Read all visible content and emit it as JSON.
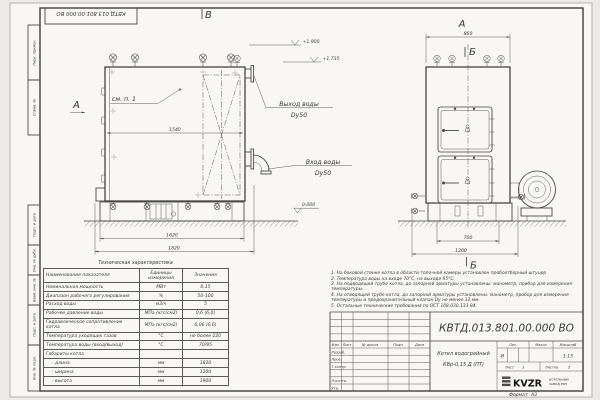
{
  "doc_number": "КВТД.013.801.00.000 ВО",
  "sheet": {
    "format_label": "Формат",
    "format_value": "А3"
  },
  "sidebar": {
    "labels": [
      "Перв. примен.",
      "Справ. №",
      "Подп. и дата",
      "Инв. № дубл.",
      "Взам. инв. №",
      "Подп. и дата",
      "Инв. № подл."
    ]
  },
  "views": {
    "marker_v": "В",
    "marker_a": "А",
    "marker_b": "Б",
    "see_item": "см. п. 1",
    "water_out": {
      "line1": "Выход воды",
      "line2": "Dy50"
    },
    "water_in": {
      "line1": "Вход воды",
      "line2": "Dy50"
    },
    "levels": {
      "top": "+1.900",
      "mid": "+1.735",
      "zero": "0.000"
    },
    "dims": {
      "front_width": "1540",
      "base": "1620",
      "overall": "1820",
      "side_top": "860",
      "side_base": "700",
      "side_overall": "1200"
    }
  },
  "table": {
    "title": "Техническая характеристика",
    "headers": [
      "Наименование показателя",
      "Единицы измерения",
      "Значения"
    ],
    "rows": [
      {
        "name": "Номинальная мощность",
        "unit": "МВт",
        "value": "0,15"
      },
      {
        "name": "Диапазон рабочего регулирования",
        "unit": "%",
        "value": "50-100"
      },
      {
        "name": "Расход воды",
        "unit": "м3/ч",
        "value": "5"
      },
      {
        "name": "Рабочее давление воды",
        "unit": "МПа (кгс/см2)",
        "value": "0,6 (6,0)"
      },
      {
        "name": "Гидравлическое сопротивление котла",
        "unit": "МПа (кгс/см2)",
        "value": "0,06 (0,6)"
      },
      {
        "name": "Температура уходящих газов",
        "unit": "°С",
        "value": "не более 220"
      },
      {
        "name": "Температура воды (вход/выход)",
        "unit": "°С",
        "value": "70/95"
      },
      {
        "name": "Габариты котла",
        "unit": "",
        "value": ""
      },
      {
        "name": "- длина",
        "unit": "мм",
        "value": "1820"
      },
      {
        "name": "- ширина",
        "unit": "мм",
        "value": "1200"
      },
      {
        "name": "- высота",
        "unit": "мм",
        "value": "1900"
      }
    ]
  },
  "notes": [
    "1. На боковой стенке котла в области топочной камеры установлен пробоотборный штуцер",
    "2. Температура воды на входе 70°С, на выходе 95°С.",
    "3. На подводящей трубе котла, до запорной арматуры установлены: манометр, прибор для измерения температуры.",
    "4. На отводящей трубе котла, до запорной арматуры установлены: манометр, прибор для измерения температуры и предохранительный клапан Dу не менее 32 мм.",
    "5. Остальные технические требования по ОСТ 108.030.133-84."
  ],
  "title_block": {
    "doc_number": "КВТД.013.801.00.000 ВО",
    "columns": [
      "Изм.",
      "Лист",
      "№ докум.",
      "Подп.",
      "Дата"
    ],
    "rows": [
      "Разраб.",
      "Пров.",
      "Т.контр.",
      "Н.контр.",
      "Утв."
    ],
    "product_name_1": "Котел водогрейный",
    "product_name_2": "КВр-0,15 Д  (ПТ)",
    "lit_header": "Лит.",
    "lit_value": "И",
    "mass_header": "Масса",
    "scale_header": "Масштаб",
    "scale_value": "1:15",
    "sheet_label": "Лист",
    "sheet_value": "1",
    "sheets_label": "Листов",
    "sheets_value": "2",
    "logo_text": "KVZR",
    "logo_sub1": "КОТЕЛЬНЫЙ",
    "logo_sub2": "ЗАВОД РЭП"
  }
}
